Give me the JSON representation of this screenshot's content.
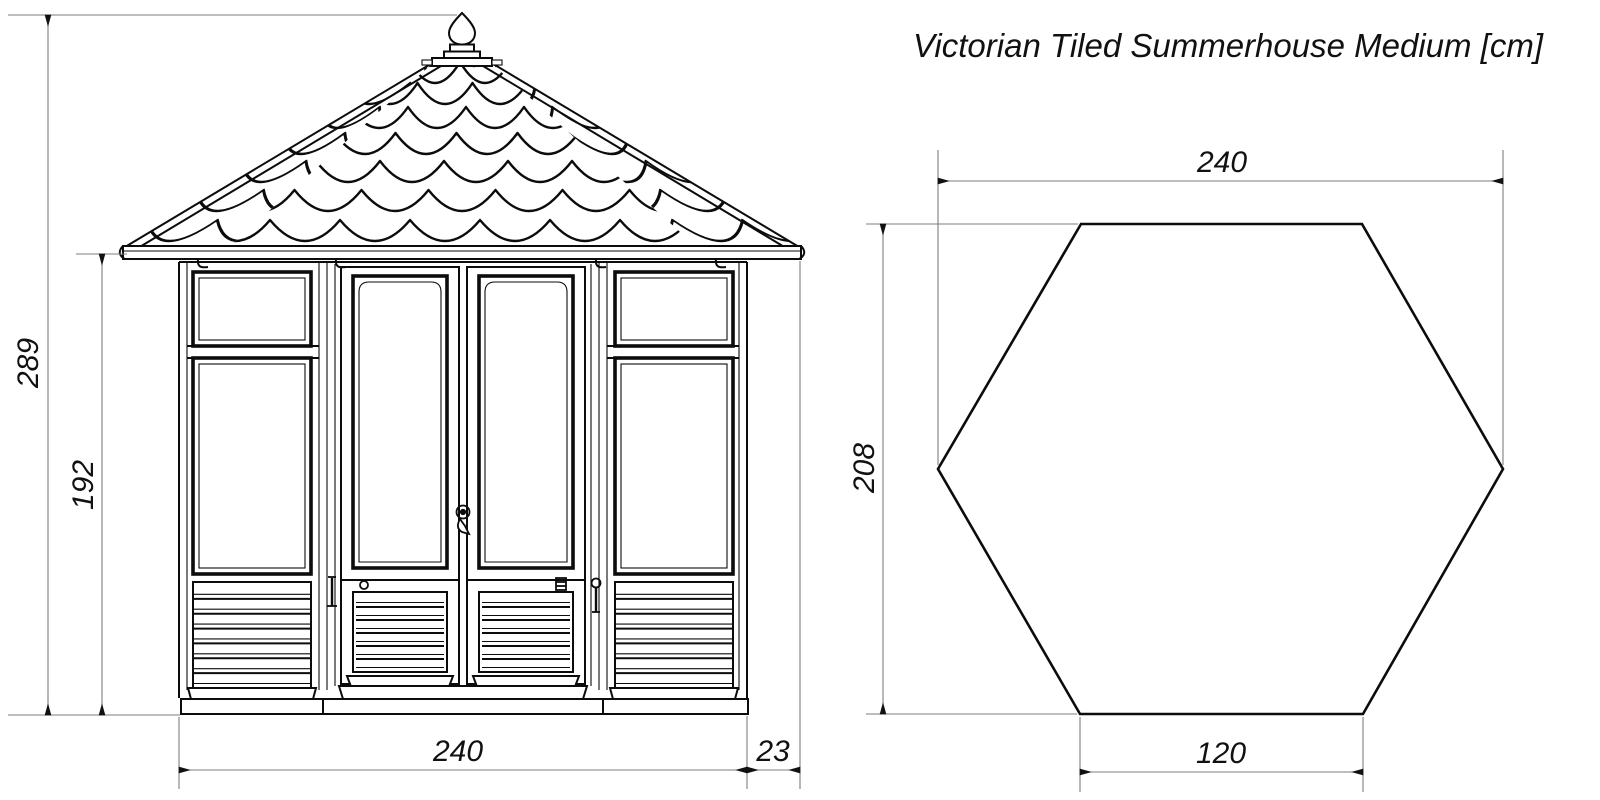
{
  "title": "Victorian Tiled Summerhouse Medium [cm]",
  "units": "cm",
  "views": {
    "elevation": {
      "label": "front-elevation",
      "dims": {
        "overall_height": "289",
        "wall_height": "192",
        "base_width": "240",
        "roof_overhang": "23"
      }
    },
    "plan": {
      "label": "hexagonal-floor-plan",
      "dims": {
        "overall_width": "240",
        "depth_across_flats": "208",
        "front_side_width": "120"
      }
    }
  },
  "colors": {
    "line": "#0c0c0c",
    "dimension_line": "#7d7d7d",
    "text": "#111111",
    "background": "#ffffff"
  }
}
